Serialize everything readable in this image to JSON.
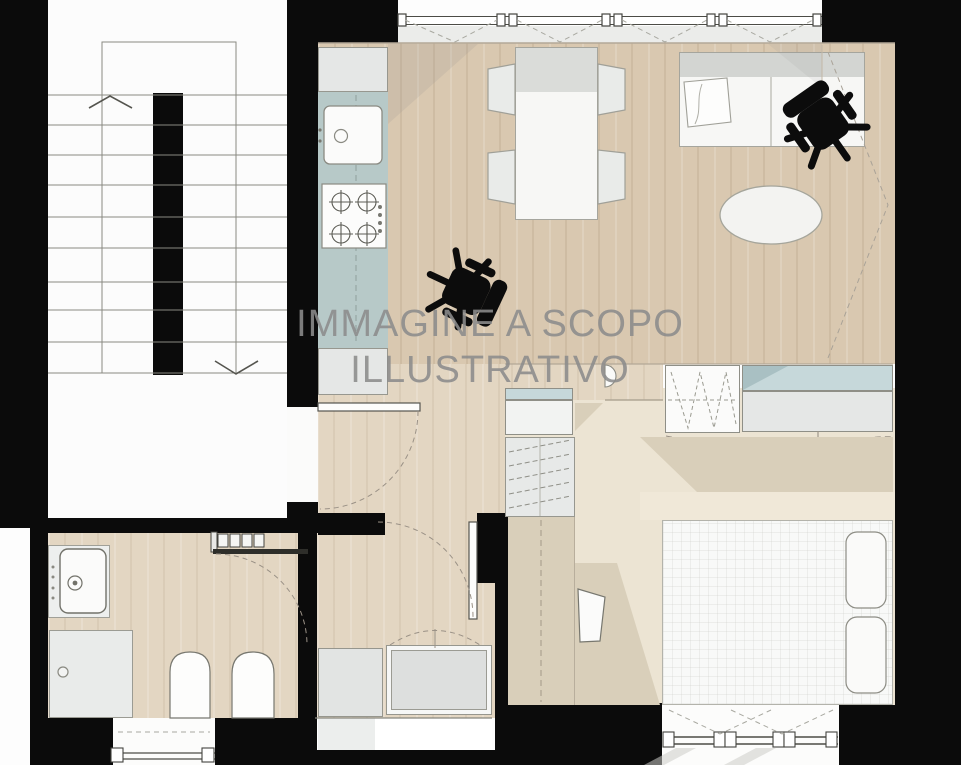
{
  "watermark": {
    "line1": "IMMAGINE A SCOPO",
    "line2": "ILLUSTRATIVO"
  },
  "plan": {
    "type": "floor-plan",
    "style": "top-down rendered apartment plan with communal staircase",
    "rooms": [
      "staircase",
      "entry-hall",
      "kitchen",
      "living-dining-room",
      "bathroom",
      "bedroom"
    ],
    "furniture": [
      "kitchen-counter",
      "sink",
      "gas-hob",
      "dining-table",
      "dining-chairs",
      "sofa",
      "office-chair",
      "round-rug",
      "wardrobe",
      "closet",
      "bed",
      "pillows",
      "washbasin",
      "shower",
      "toilet",
      "bidet"
    ]
  },
  "colors": {
    "wall": "#0b0b0b",
    "wood": "#d9c8b0",
    "wood-light": "#e3d6c2",
    "cream": "#ece4d3",
    "cream-dark": "#d9cfba",
    "counter": "#b7c9c8",
    "teal": "#c6d8da",
    "unit": "#e5e7e6",
    "furn-white": "#f7f7f5",
    "line": "#8d8d85",
    "watermark": "#8c8c8c"
  }
}
